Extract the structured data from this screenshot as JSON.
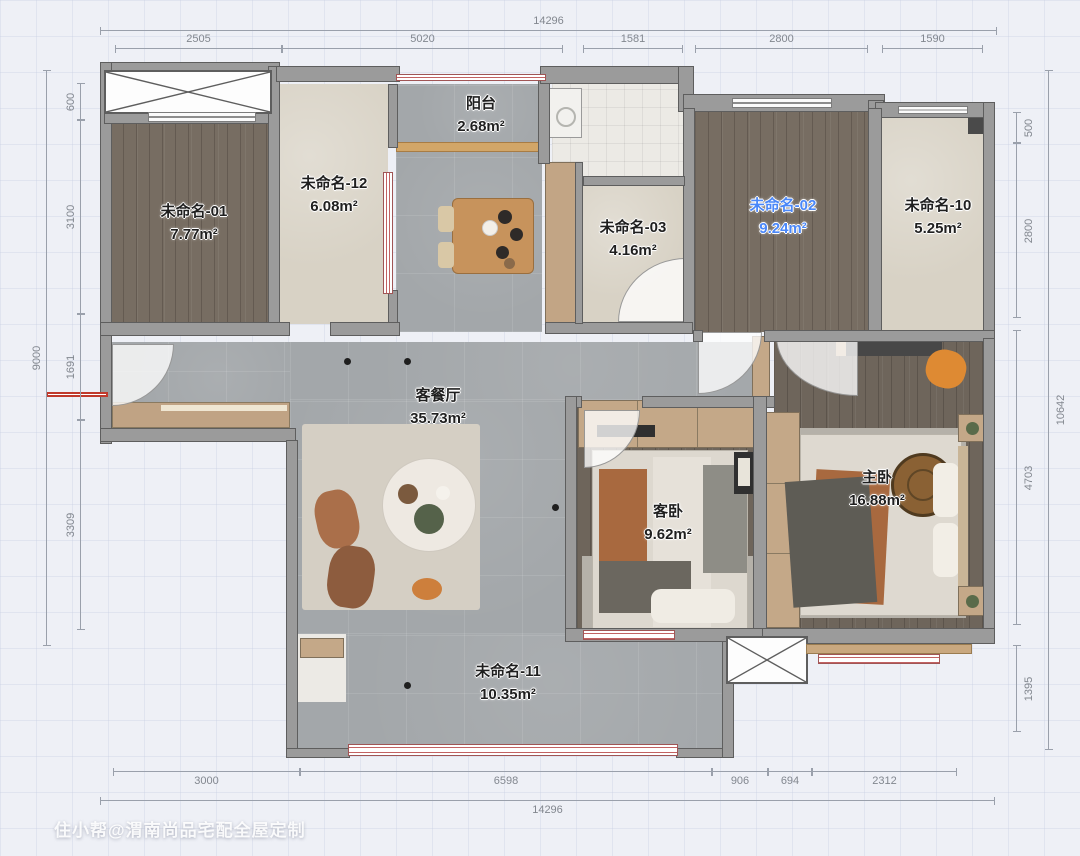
{
  "rooms": [
    {
      "name": "未命名-01",
      "area": "7.77m²"
    },
    {
      "name": "未命名-12",
      "area": "6.08m²"
    },
    {
      "name": "阳台",
      "area": "2.68m²"
    },
    {
      "name": "未命名-03",
      "area": "4.16m²"
    },
    {
      "name": "未命名-02",
      "area": "9.24m²",
      "selected": true
    },
    {
      "name": "未命名-10",
      "area": "5.25m²"
    },
    {
      "name": "客餐厅",
      "area": "35.73m²"
    },
    {
      "name": "客卧",
      "area": "9.62m²"
    },
    {
      "name": "主卧",
      "area": "16.88m²"
    },
    {
      "name": "未命名-11",
      "area": "10.35m²"
    }
  ],
  "dims": {
    "top_total": "14296",
    "top": [
      "2505",
      "5020",
      "1581",
      "2800",
      "1590"
    ],
    "left_total": "9000",
    "left": [
      "600",
      "3100",
      "1691",
      "3309"
    ],
    "right_total": "10642",
    "right": [
      "500",
      "2800",
      "4703",
      "1395"
    ],
    "bottom": [
      "3000",
      "6598",
      "906",
      "694",
      "2312"
    ],
    "bottom_total": "14296"
  },
  "watermark": "住小帮@渭南尚品宅配全屋定制",
  "colors": {
    "selected_label": "#4a87f8",
    "window_accent": "#c26262",
    "wall": "#9b9b9b",
    "dim_text": "#82878f"
  }
}
